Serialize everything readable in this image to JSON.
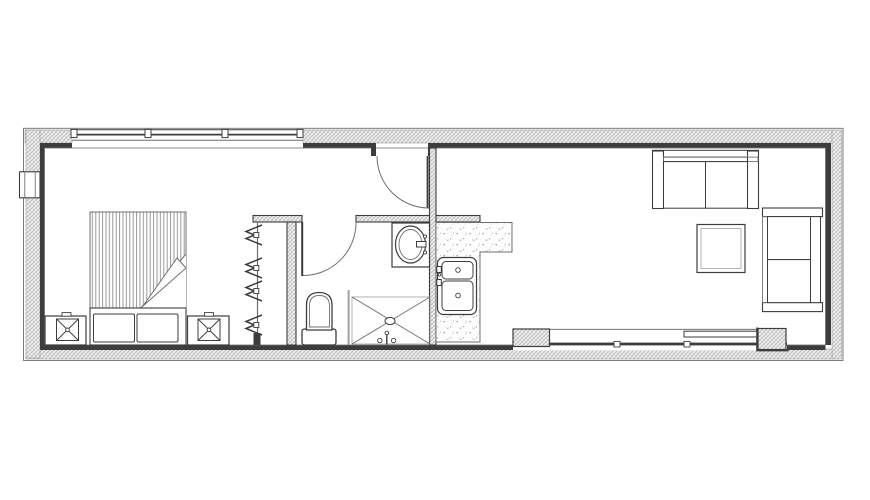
{
  "meta": {
    "aria_label": "floor-plan",
    "type": "architectural-floor-plan"
  },
  "colors": {
    "ink": "#3d3d3d",
    "mid": "#6f6f6f",
    "lite": "#a0a0a0",
    "hatch": "#b3b3b3",
    "paper": "#ffffff"
  },
  "plan": {
    "zones": [
      "bedroom",
      "wardrobe",
      "bathroom",
      "kitchen",
      "living"
    ],
    "fixtures": [
      "strip-window",
      "entry-door",
      "wall-vent",
      "bed",
      "duvet-fold",
      "pillows",
      "nightstand-lamp-left",
      "nightstand-lamp-right",
      "wardrobe-rail",
      "clothes-hangers",
      "bathroom-door",
      "toilet",
      "vanity-oval-sink",
      "shower-pan",
      "shower-drain",
      "kitchen-counter",
      "double-bowl-sink",
      "sliding-glass-door",
      "sofa",
      "loveseat",
      "coffee-table"
    ],
    "counts": {
      "window_posts": 4,
      "clothes_hangers": 4,
      "bed_pillows": 2,
      "sink_bowls": 2,
      "sofa_cushions": 2,
      "loveseat_cushions": 2,
      "nightstands": 2,
      "doors": 3
    }
  }
}
